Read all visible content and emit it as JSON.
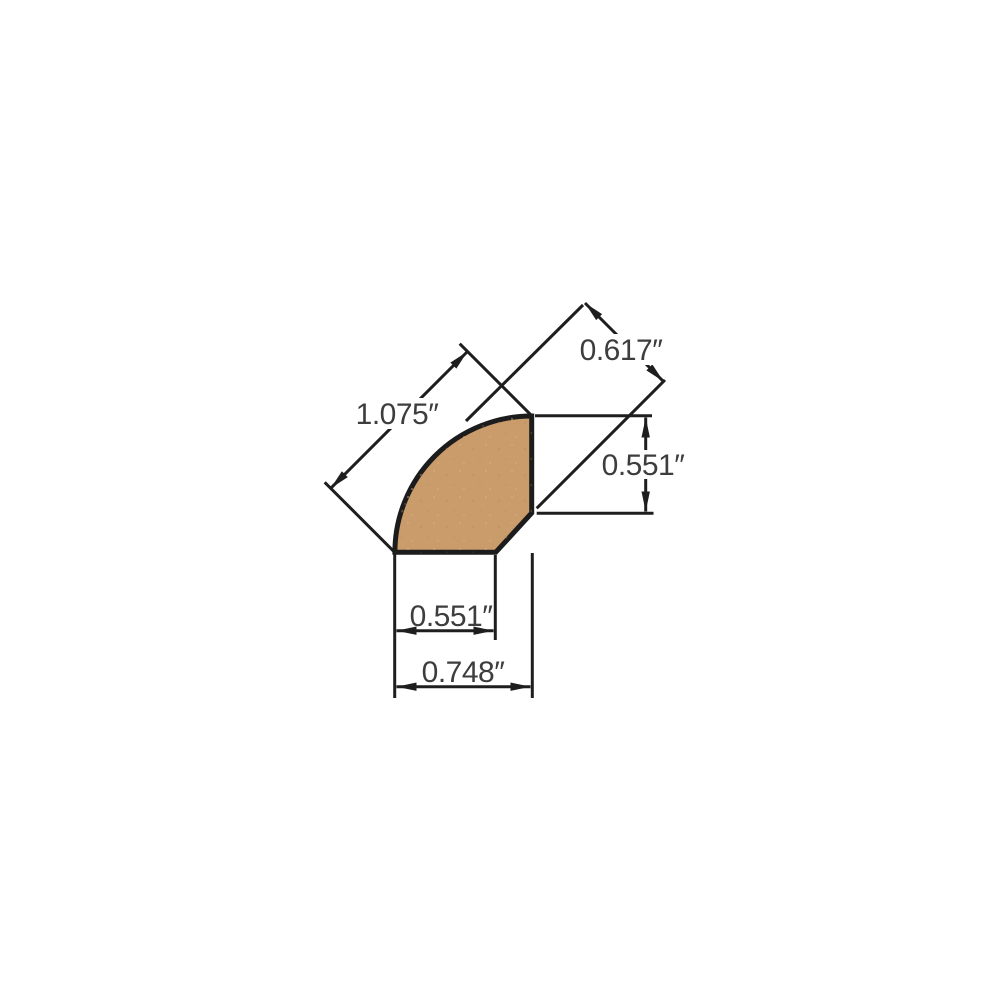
{
  "canvas": {
    "background_color": "#ffffff"
  },
  "diagram": {
    "title": "quarter round molding profile cross-section",
    "unit": "inches",
    "profile": {
      "shape": "quarter-round with back chamfer",
      "fill_color": "#ca9c6b",
      "outline_color": "#1c1c1c"
    },
    "annotation_style": {
      "line_color": "#1e1e1e",
      "text_color": "#3d3d3d"
    },
    "dimensions": [
      {
        "id": "diagonal-face-width",
        "label": "1.075″",
        "value": 1.075,
        "orientation": "diagonal-45",
        "position": "upper-left"
      },
      {
        "id": "back-thickness",
        "label": "0.617″",
        "value": 0.617,
        "orientation": "diagonal-45",
        "position": "upper-right"
      },
      {
        "id": "side-height",
        "label": "0.551″",
        "value": 0.551,
        "orientation": "vertical",
        "position": "right"
      },
      {
        "id": "bottom-flat-width",
        "label": "0.551″",
        "value": 0.551,
        "orientation": "horizontal",
        "position": "bottom"
      },
      {
        "id": "overall-width",
        "label": "0.748″",
        "value": 0.748,
        "orientation": "horizontal",
        "position": "bottom-outer"
      }
    ]
  }
}
